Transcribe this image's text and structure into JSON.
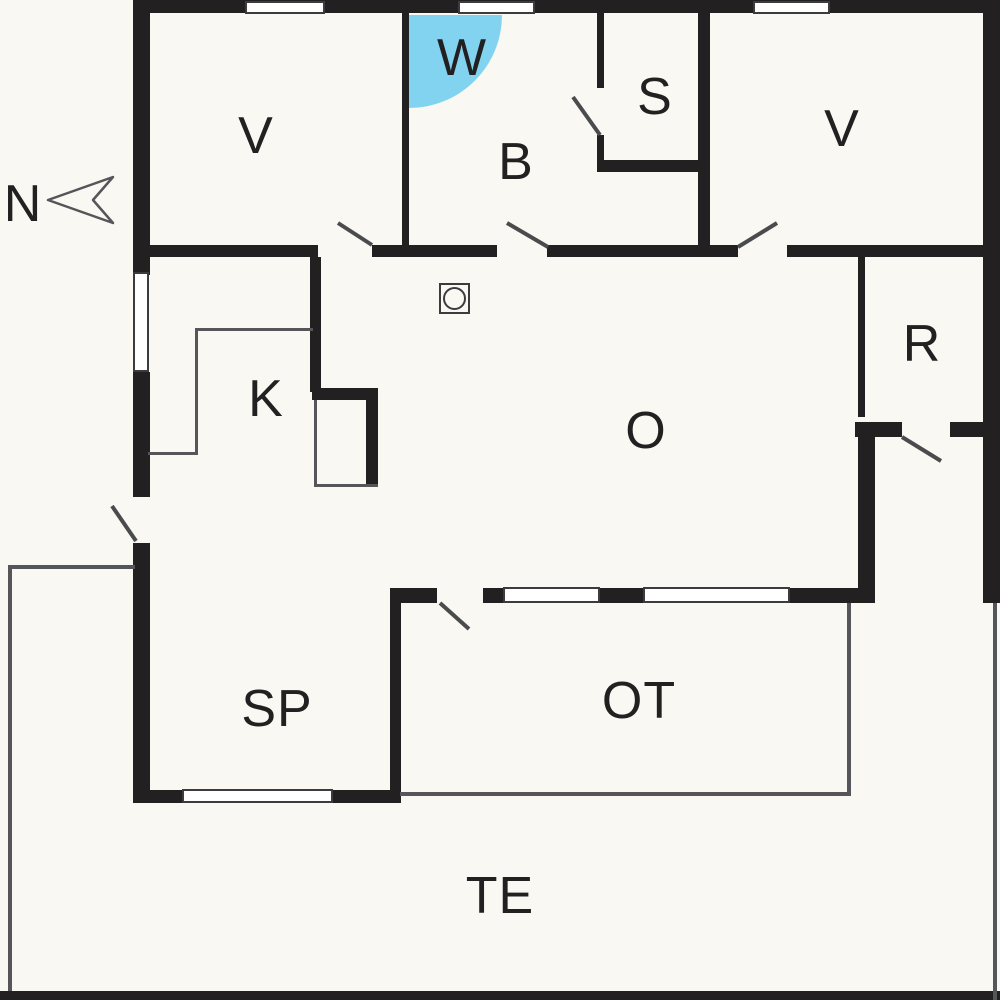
{
  "title": "Holiday home floor plan",
  "compass": {
    "label": "N"
  },
  "rooms": {
    "v1": {
      "label": "V"
    },
    "w": {
      "label": "W"
    },
    "b": {
      "label": "B"
    },
    "s": {
      "label": "S"
    },
    "v2": {
      "label": "V"
    },
    "k": {
      "label": "K"
    },
    "o": {
      "label": "O"
    },
    "r": {
      "label": "R"
    },
    "sp": {
      "label": "SP"
    },
    "ot": {
      "label": "OT"
    },
    "te": {
      "label": "TE"
    }
  },
  "icons": {
    "shower": "quarter-circle-shower",
    "stove": "wood-stove",
    "north_arrow": "north-dart"
  },
  "colors": {
    "wall": "#232021",
    "floor": "#f9f8f2",
    "line": "#55565a",
    "swing": "#4a4b4d",
    "shower": "#82d3f0",
    "label": "#232021"
  }
}
